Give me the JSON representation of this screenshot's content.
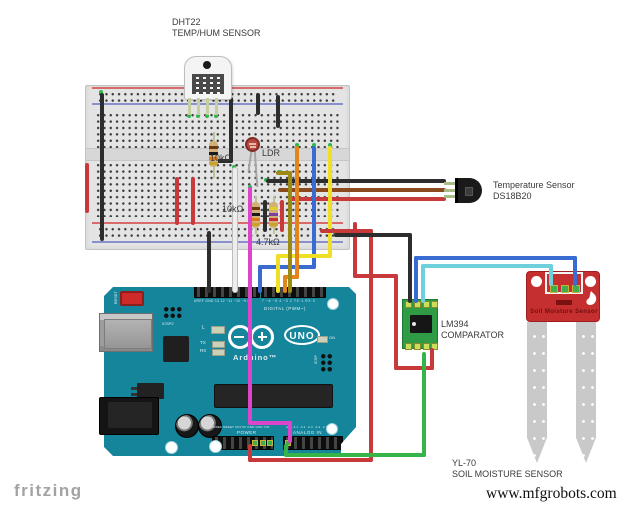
{
  "labels": {
    "dht22": "DHT22",
    "dht22_sub": "TEMP/HUM SENSOR",
    "resistor1": "10kΩ",
    "ldr": "LDR",
    "resistor2": "10kΩ",
    "resistor3": "4.7kΩ",
    "temp_sensor": "Temperature Sensor",
    "temp_sensor_model": "DS18B20",
    "comparator_model": "LM394",
    "comparator": "COMPARATOR",
    "soil_model": "YL-70",
    "soil": "SOIL MOISTURE SENSOR",
    "fritzing": "fritzing",
    "watermark": "www.mfgrobots.com"
  },
  "arduino": {
    "reset": "RESET",
    "icsp2": "ICSP2",
    "icsp": "ICSP",
    "led_l": "L",
    "tx": "TX",
    "rx": "RX",
    "on": "ON",
    "brand": "Arduino™",
    "model": "UNO",
    "digital_label": "DIGITAL (PWM~)",
    "digital_pins_left": "AREF GND 13 12 ~11 ~10 ~9 8",
    "digital_pins_right": "7 ~6 ~5 4 ~3 2 TX·1 RX·0",
    "power_label": "POWER",
    "power_pins": "IOREF RESET 3V3 5V GND GND VIN",
    "analog_label": "ANALOG IN",
    "analog_pins": "A0 A1 A2 A3 A4 A5"
  },
  "soil_board": {
    "title": "Soil Moisture Sensor"
  },
  "colors": {
    "wire_red": "#c8393c",
    "wire_black": "#2d2d2d",
    "wire_white": "#ededed",
    "wire_magenta": "#dd44cc",
    "wire_blue": "#3a6bd0",
    "wire_cyan": "#6fd0dd",
    "wire_yellow": "#efe025",
    "wire_orange": "#e2851b",
    "wire_olive": "#9c8a15",
    "wire_brown": "#8a4a1e",
    "wire_green": "#35b44a",
    "arduino_teal": "#15859c",
    "breadboard": "#e4e4e4",
    "lm394_green": "#2f9b44",
    "soil_red": "#c62f2f",
    "label_text": "#3a3a3a",
    "fritzing_gray": "#a3a3a3",
    "rail_red": "#d96a6a",
    "rail_blue": "#8891cc"
  }
}
